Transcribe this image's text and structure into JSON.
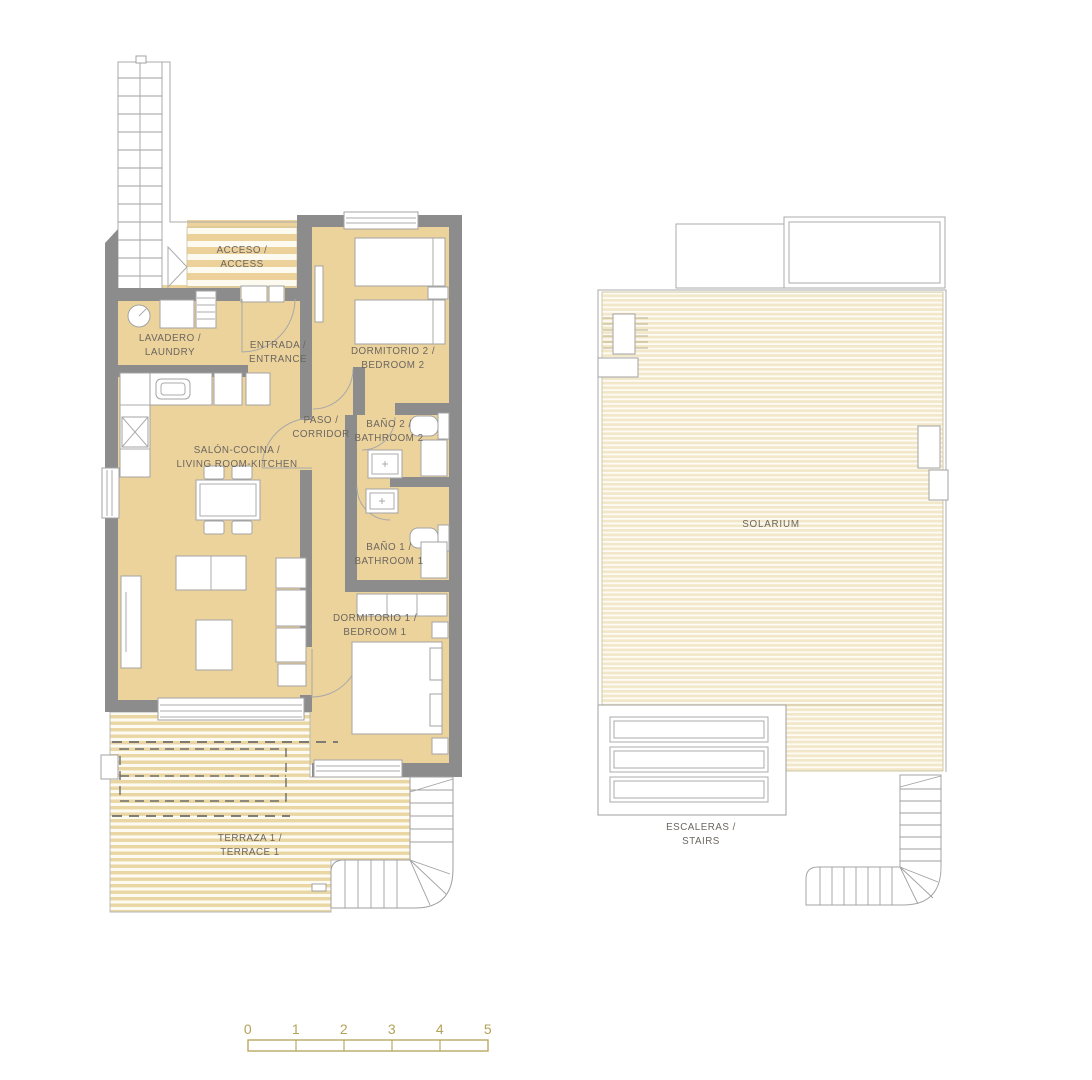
{
  "colors": {
    "floor": "#ecd39c",
    "wall": "#8c8c8c",
    "terrace_stripe": "#e9d6a2",
    "solarium_stripe": "#f2e7c8",
    "outline": "#ababab",
    "label_text": "#6b6661",
    "scale": "#b3a258"
  },
  "ground_floor": {
    "rooms": {
      "acceso": {
        "line1": "ACCESO /",
        "line2": "ACCESS"
      },
      "lavadero": {
        "line1": "LAVADERO /",
        "line2": "LAUNDRY"
      },
      "entrada": {
        "line1": "ENTRADA /",
        "line2": "ENTRANCE"
      },
      "dormitorio2": {
        "line1": "DORMITORIO 2 /",
        "line2": "BEDROOM 2"
      },
      "paso": {
        "line1": "PASO /",
        "line2": "CORRIDOR"
      },
      "bano2": {
        "line1": "BAÑO 2 /",
        "line2": "BATHROOM 2"
      },
      "salon": {
        "line1": "SALÓN-COCINA /",
        "line2": "LIVING ROOM-KITCHEN"
      },
      "bano1": {
        "line1": "BAÑO 1 /",
        "line2": "BATHROOM 1"
      },
      "dormitorio1": {
        "line1": "DORMITORIO 1 /",
        "line2": "BEDROOM 1"
      },
      "terraza": {
        "line1": "TERRAZA 1 /",
        "line2": "TERRACE 1"
      }
    }
  },
  "solarium_floor": {
    "rooms": {
      "solarium": {
        "line1": "SOLARIUM"
      },
      "escaleras": {
        "line1": "ESCALERAS /",
        "line2": "STAIRS"
      }
    }
  },
  "scale_bar": {
    "labels": [
      "0",
      "1",
      "2",
      "3",
      "4",
      "5"
    ]
  }
}
